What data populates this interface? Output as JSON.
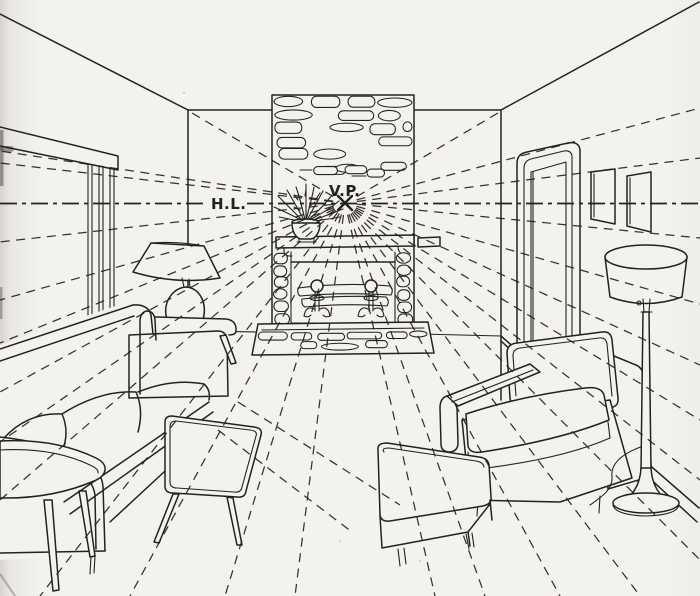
{
  "labels": {
    "horizon_line": "H.L.",
    "vanishing_point": "V.P."
  },
  "colors": {
    "ink": "#242220",
    "paper": "#f4f2ee"
  }
}
